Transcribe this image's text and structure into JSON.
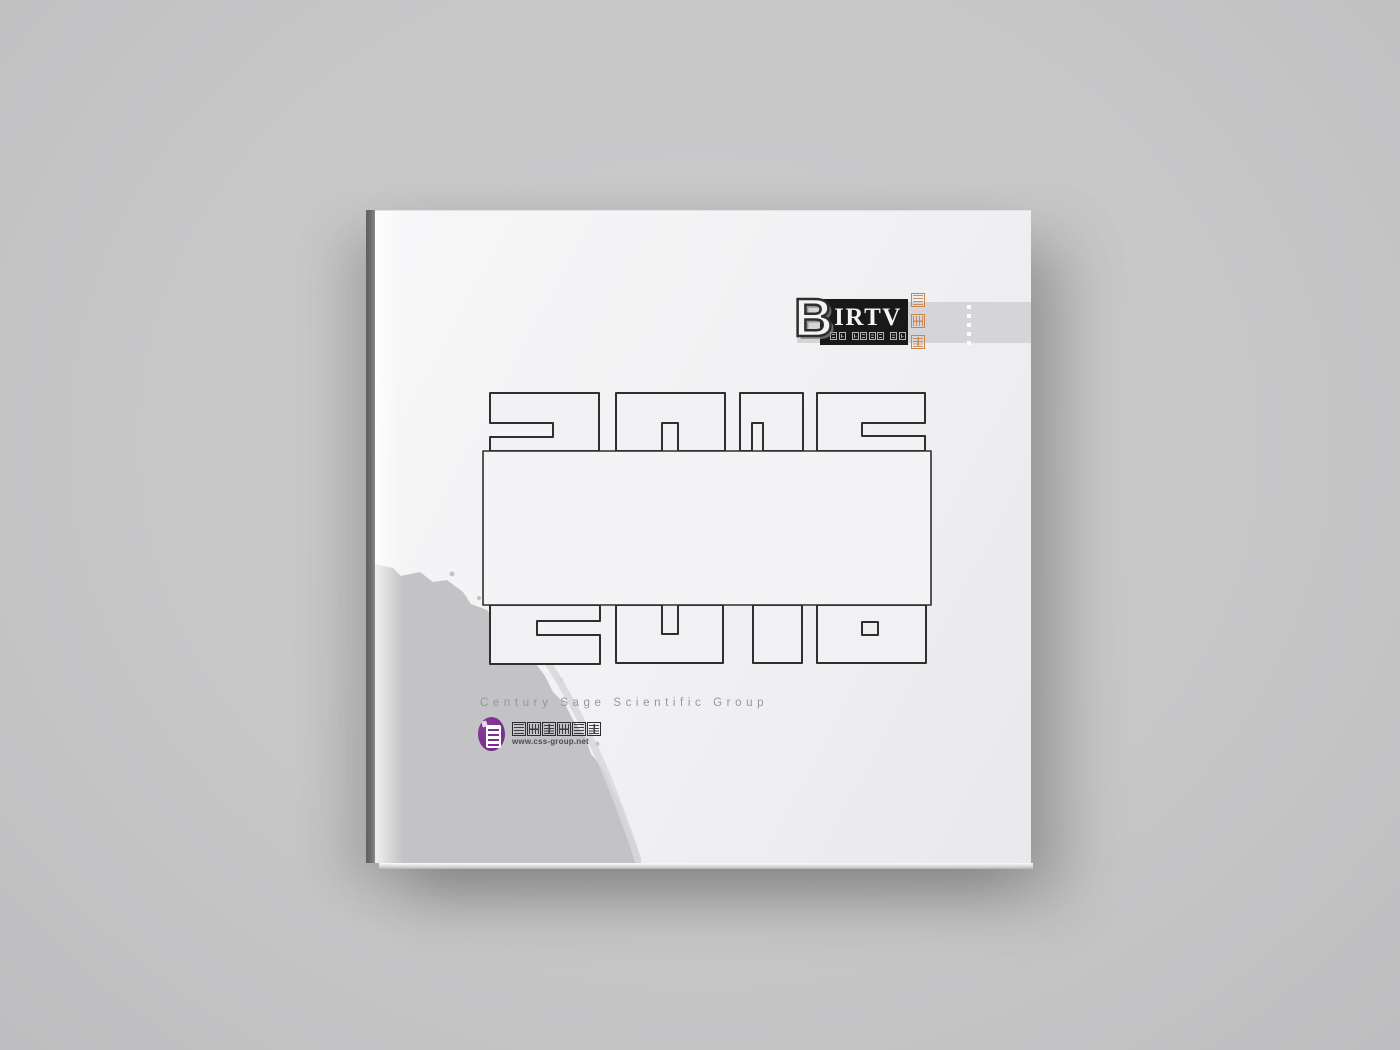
{
  "scene": {
    "background": "#c7c7c8"
  },
  "cover": {
    "year": "2016",
    "brand": {
      "b": "B",
      "irtv": "IRTV",
      "tagline_cn": "国际广播电影电视展",
      "memorial_cn": "纪念册",
      "accent_orange": "#c8854e"
    },
    "company_en": "Century Sage Scientific Group",
    "company_cn": "世纪赛科集团",
    "website": "www.css-group.net",
    "seal_purple": "#7b2e8e",
    "band_color": "#d5d5d7",
    "outline_color": "#2f2f2f"
  }
}
